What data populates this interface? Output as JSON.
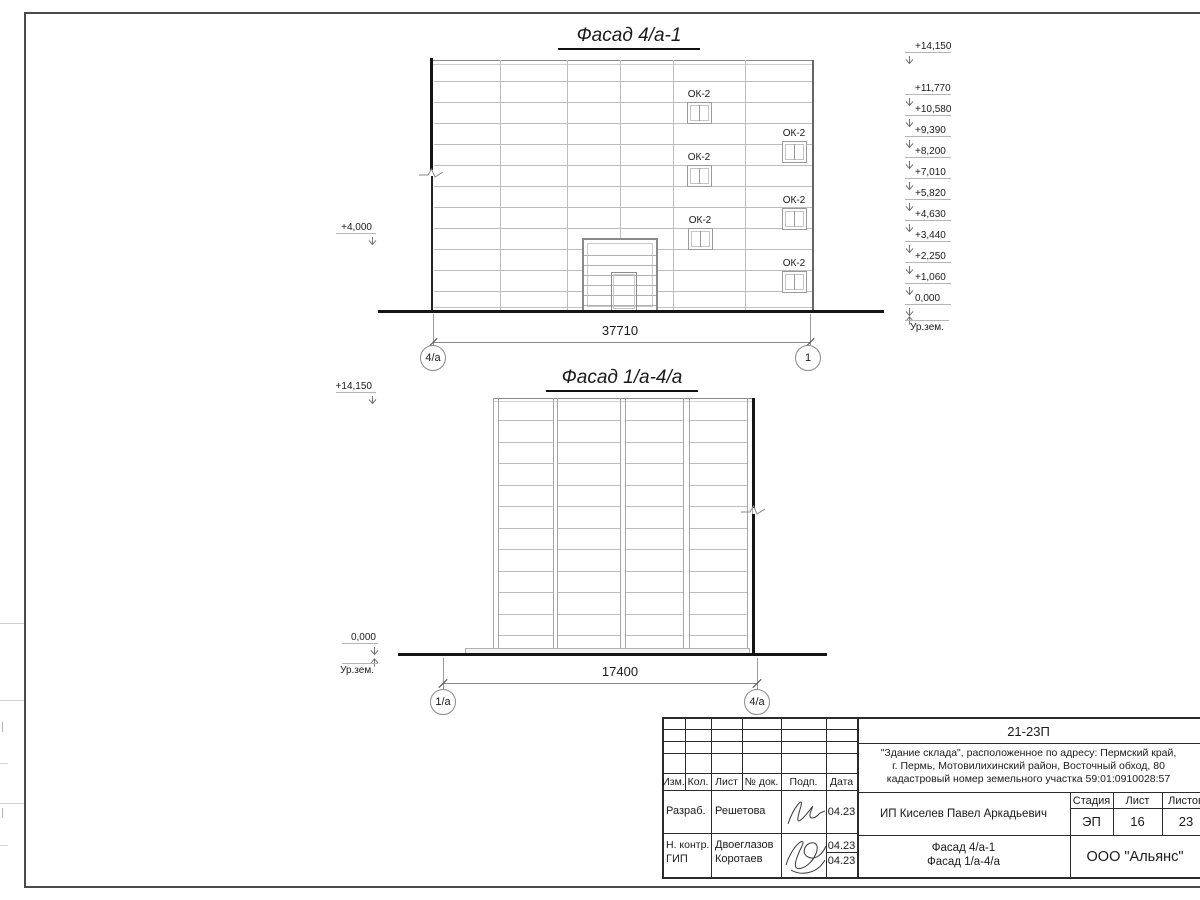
{
  "facade1": {
    "title": "Фасад 4/а-1",
    "dimension_label": "37710",
    "axis_left_label": "4/а",
    "axis_right_label": "1",
    "window_tag": "ОК-2",
    "left_elevation_label": "+4,000",
    "right_elevations": [
      "+14,150",
      "+11,770",
      "+10,580",
      "+9,390",
      "+8,200",
      "+7,010",
      "+5,820",
      "+4,630",
      "+3,440",
      "+2,250",
      "+1,060",
      "0,000"
    ],
    "ground_level_label": "Ур.зем."
  },
  "facade2": {
    "title": "Фасад 1/а-4/а",
    "dimension_label": "17400",
    "axis_left_label": "1/а",
    "axis_right_label": "4/а",
    "top_elevation_label": "+14,150",
    "zero_elevation_label": "0,000",
    "ground_level_label": "Ур.зем."
  },
  "title_block": {
    "project_code": "21-23П",
    "project_description_line1": "\"Здание склада\", расположенное по адресу: Пермский край,",
    "project_description_line2": "г. Пермь, Мотовилихинский район, Восточный обход, 80",
    "project_description_line3": "кадастровый номер земельного участка 59:01:0910028:57",
    "client": "ИП Киселев Павел Аркадьевич",
    "sheet_title_line1": "Фасад 4/а-1",
    "sheet_title_line2": "Фасад 1/а-4/а",
    "organization": "ООО \"Альянс\"",
    "col_izm": "Изм.",
    "col_kol": "Кол.",
    "col_list": "Лист",
    "col_doc": "№ док.",
    "col_podp": "Подп.",
    "col_data": "Дата",
    "stage_header": "Стадия",
    "sheet_header": "Лист",
    "sheets_header": "Листов",
    "stage": "ЭП",
    "sheet_number": "16",
    "sheets_total": "23",
    "rows": [
      {
        "role": "Разраб.",
        "name": "Решетова",
        "date": "04.23"
      },
      {
        "role": "Н. контр.",
        "name": "Двоеглазов",
        "date": "04.23"
      },
      {
        "role": "ГИП",
        "name": "Коротаев",
        "date": "04.23"
      }
    ]
  }
}
